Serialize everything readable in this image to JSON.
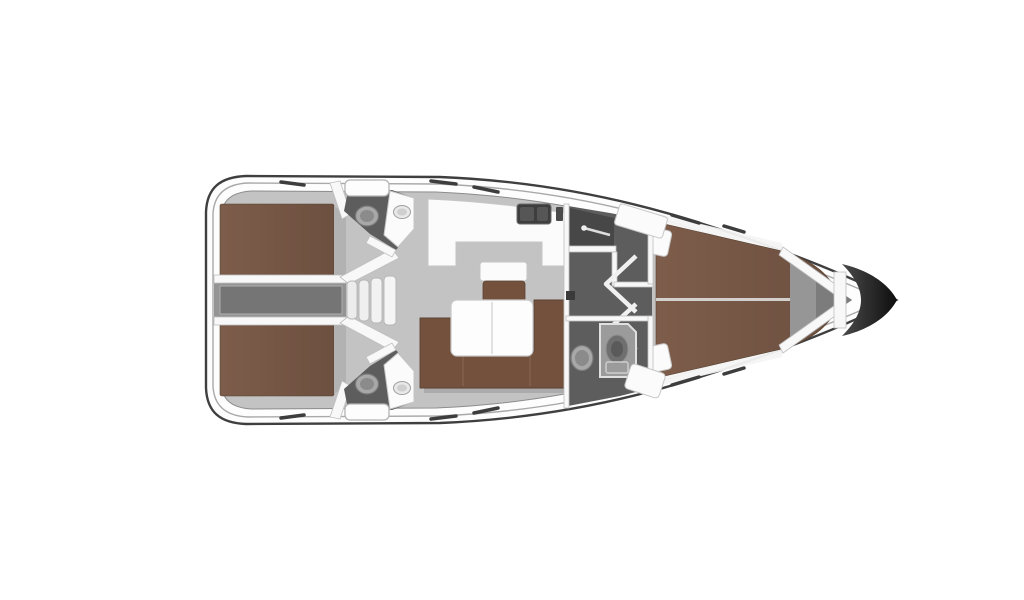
{
  "scene": {
    "description": "sailing-yacht-interior-floor-plan-top-view",
    "orientation": "bow-right",
    "components": [
      "hull",
      "stern-transom",
      "aft-cabin-port",
      "aft-cabin-starboard",
      "engine-corridor",
      "companionway-stairs",
      "aft-head-port",
      "aft-head-starboard",
      "galley",
      "salon-table",
      "salon-sofa",
      "salon-stool",
      "forward-head",
      "wardrobe",
      "shower",
      "forward-cabin-vberth",
      "anchor-locker",
      "bow-tip",
      "deck-hatches",
      "hull-windows"
    ]
  },
  "colors": {
    "background": "#ffffff",
    "hull_line": "#3f3f3f",
    "deck_inner_line": "#9a9a9a",
    "floor_gray": "#c3c3c3",
    "berth_brown": "#6d5040",
    "berth_brown_light": "#7d5c4a",
    "sofa_brown": "#74513d",
    "table_white": "#fdfdfd",
    "head_floor": "#5d5d5d",
    "wardrobe_floor": "#474747",
    "corridor_gray": "#949494",
    "engine_hatch": "#757575",
    "fixture_light": "#a8a8a8",
    "fixture_mid": "#8b8b8b",
    "sink_dark": "#3e3e3e",
    "shower_pan": "#9b9b9b",
    "anchor_locker": "#969696",
    "anchor_locker_dark": "#7c7c7c",
    "bow_dark": "#0e0e0e",
    "bow_mid": "#4a4a4a",
    "wall_white": "#f8f8f8"
  }
}
